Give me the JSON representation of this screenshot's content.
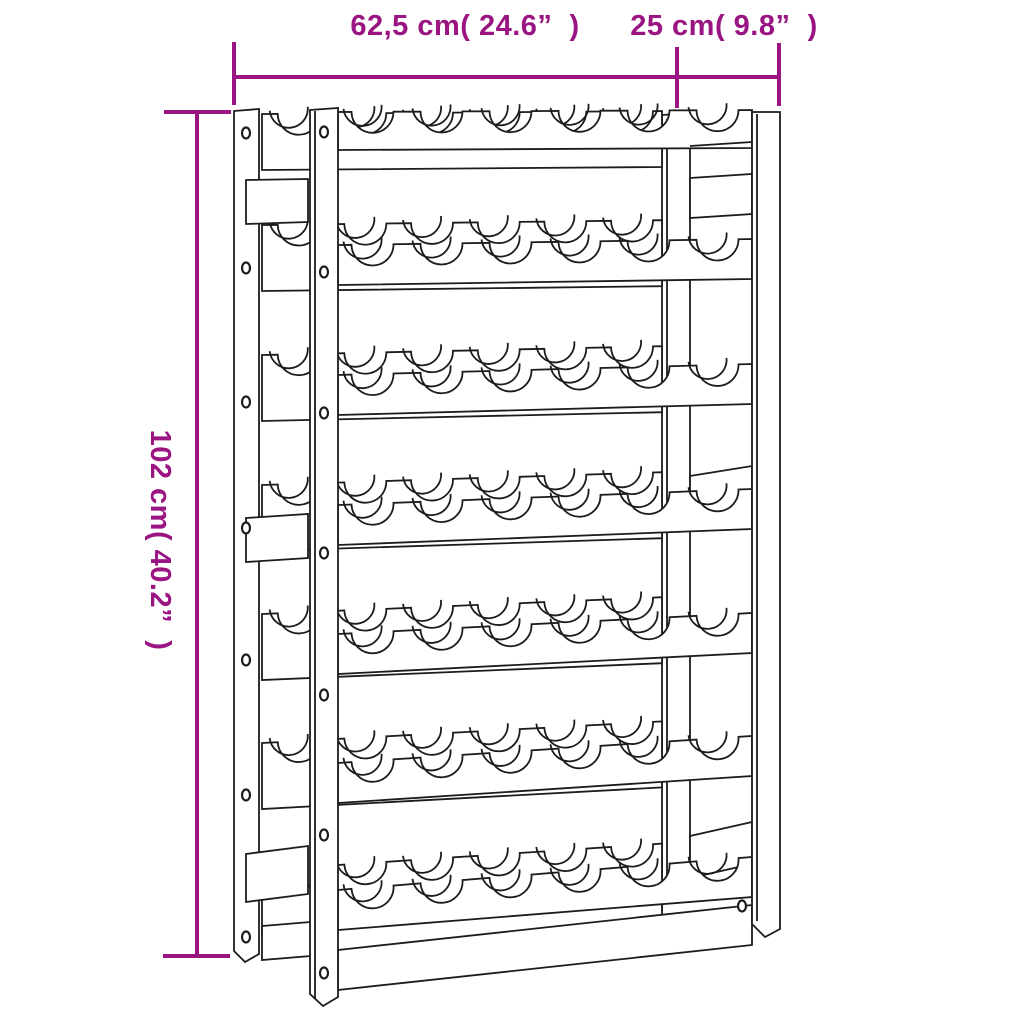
{
  "figure": {
    "type": "wine-rack-dimension-diagram",
    "rows": 7,
    "bottles_per_row": 6,
    "line_color": "#1C1C1C",
    "background_color": "#FFFFFF"
  },
  "dimensions": {
    "color": "#9A1581",
    "width_label": "62,5 cm( 24.6”  )",
    "depth_label": "25 cm( 9.8”  )",
    "height_label": "102 cm( 40.2”  )"
  }
}
